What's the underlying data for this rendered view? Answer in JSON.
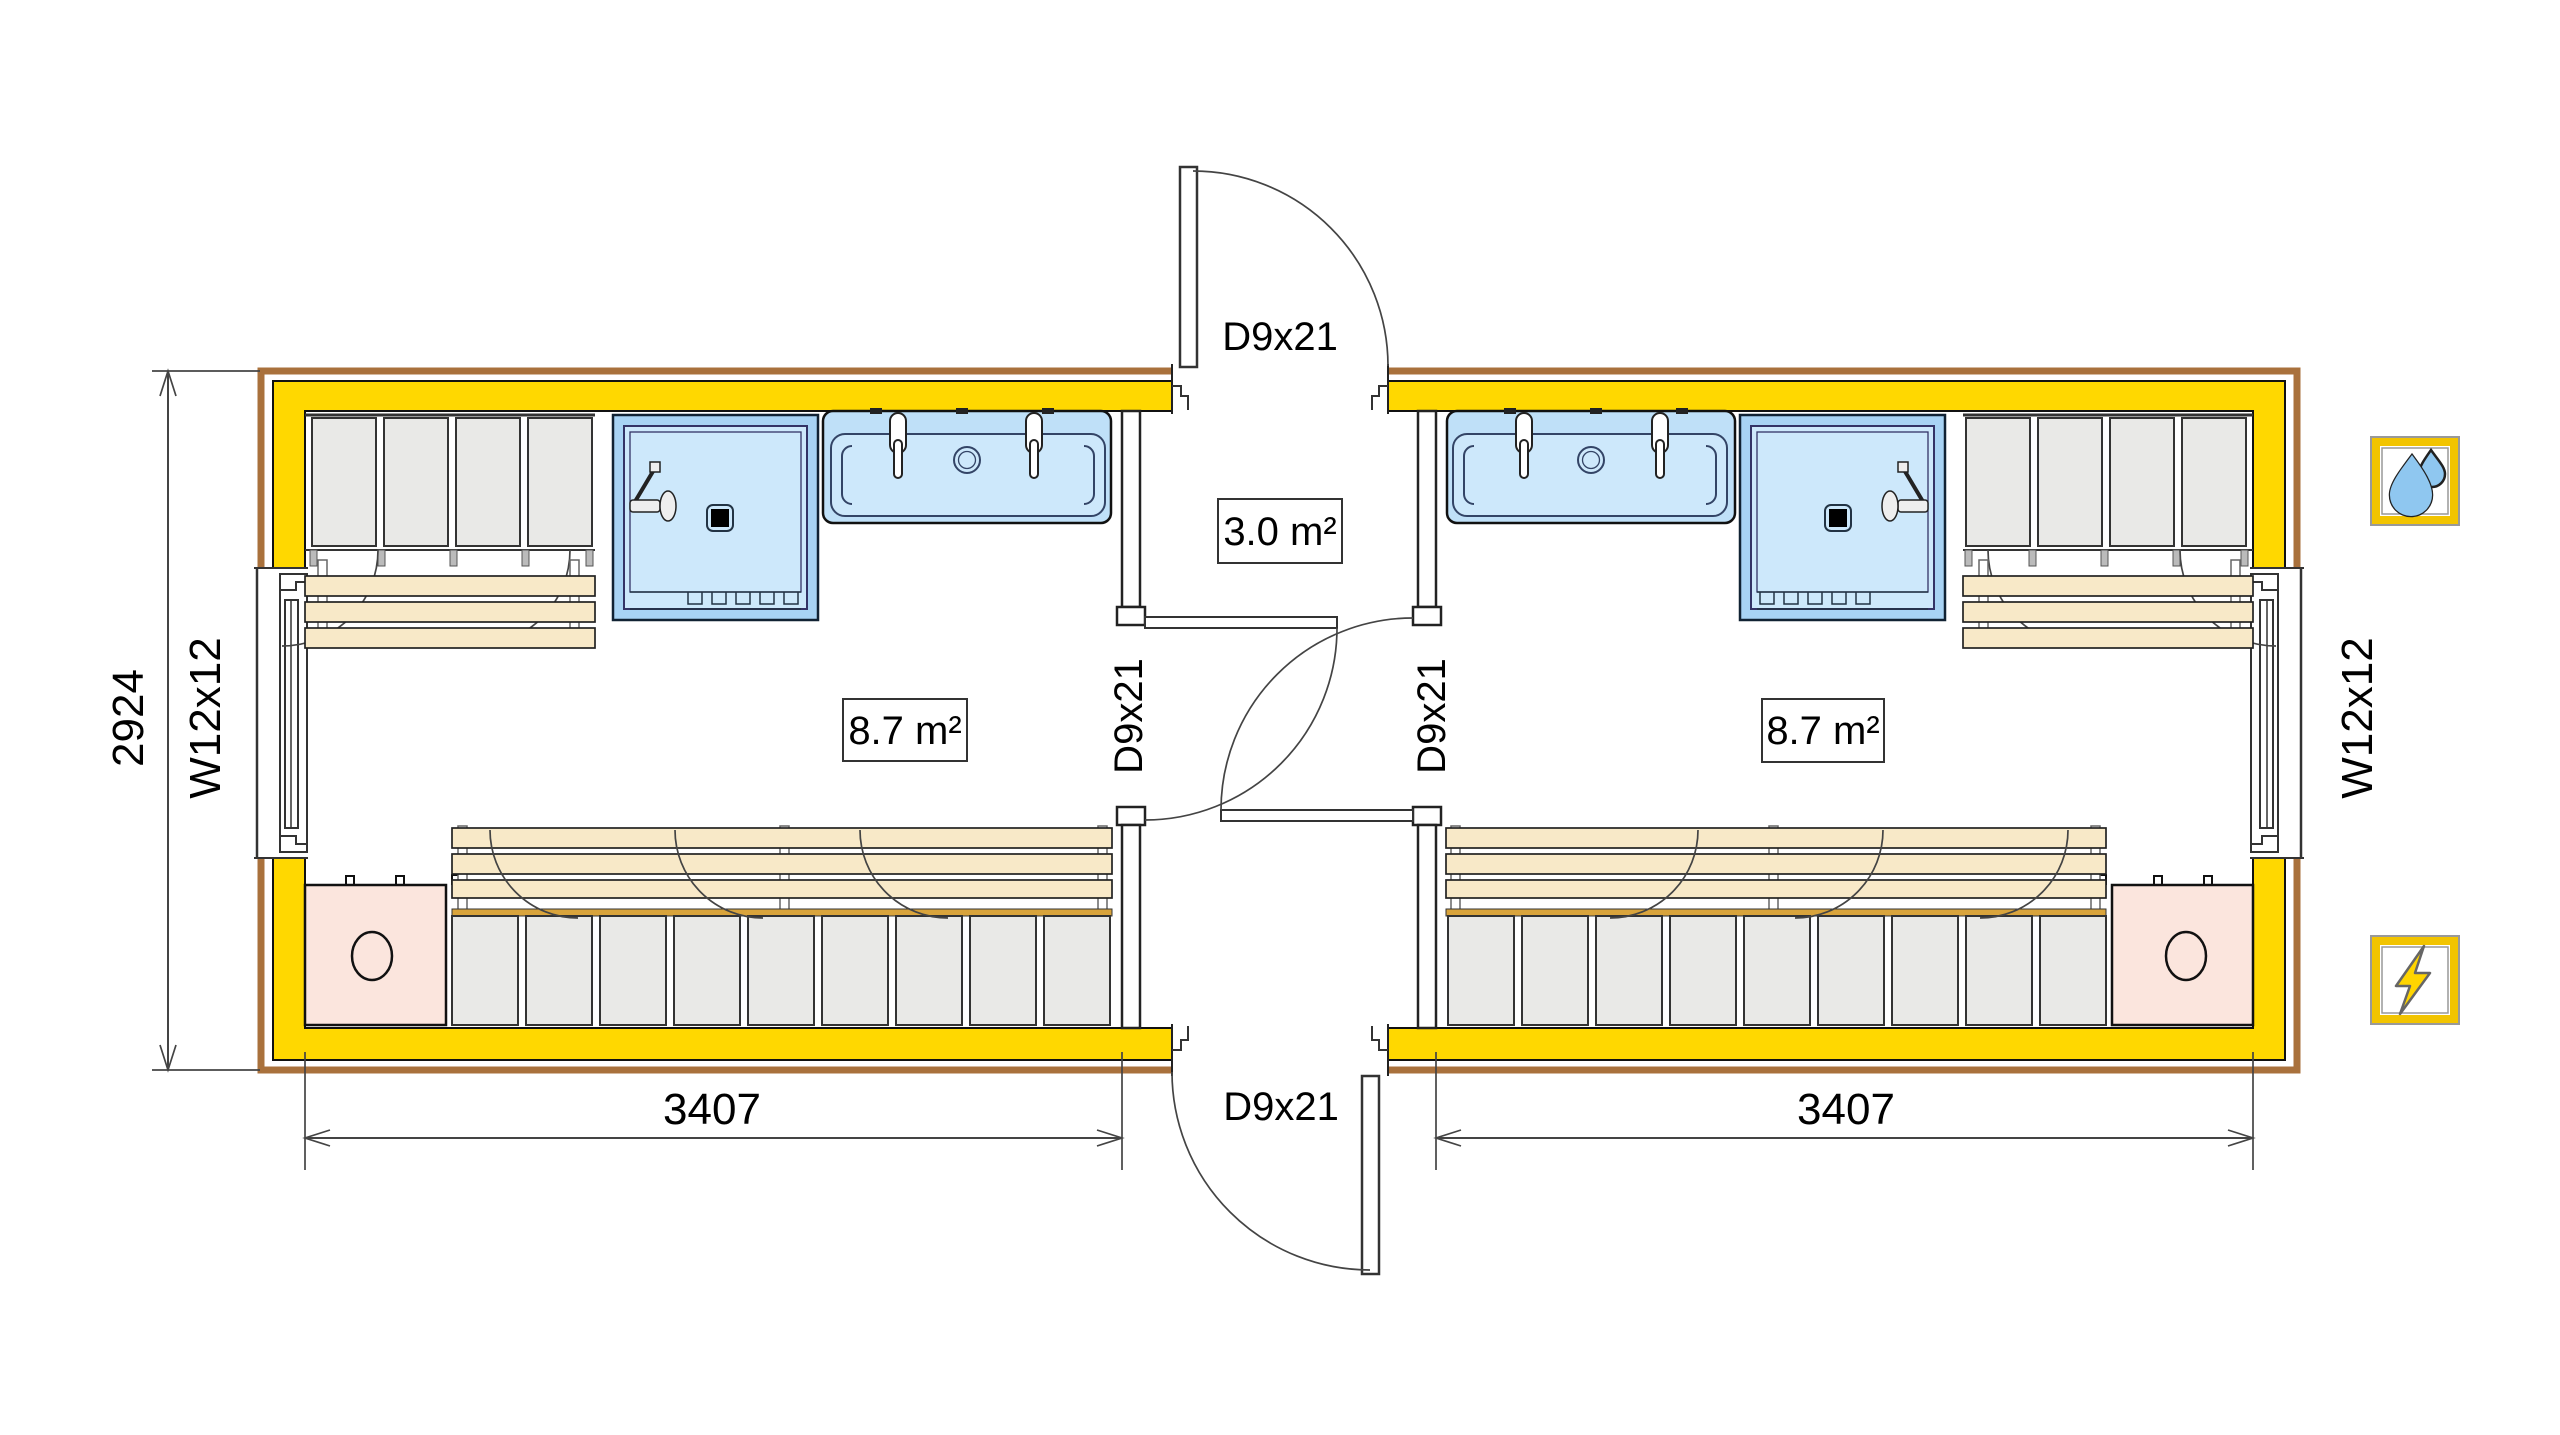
{
  "labels": {
    "hall_area": "3.0 m²",
    "left_room_area": "8.7 m²",
    "right_room_area": "8.7 m²",
    "door_top": "D9x21",
    "door_bottom": "D9x21",
    "door_left_room": "D9x21",
    "door_right_room": "D9x21",
    "window_left": "W12x12",
    "window_right": "W12x12",
    "dim_height": "2924",
    "dim_left_module": "3407",
    "dim_right_module": "3407"
  },
  "icons": {
    "water_supply": "water-drops-icon",
    "electricity": "lightning-bolt-icon"
  },
  "colors": {
    "wall_yellow": "#FFD800",
    "cladding_brown": "#A9713C",
    "fixture_blue": "#BFE0F8",
    "shower_blue": "#A8D3F4",
    "basin_blue": "#CDE8FB",
    "bench_wood": "#F8E9C8",
    "locker_grey": "#E9E9E7",
    "locker_strip_orange": "#D9A43C",
    "counter_pink": "#FBE5DD",
    "drop_blue": "#8FC7F0",
    "bolt_yellow": "#FFD500",
    "icon_frame_yellow": "#F2C400",
    "line_black": "#1a1a1a",
    "dim_grey": "#444444"
  }
}
